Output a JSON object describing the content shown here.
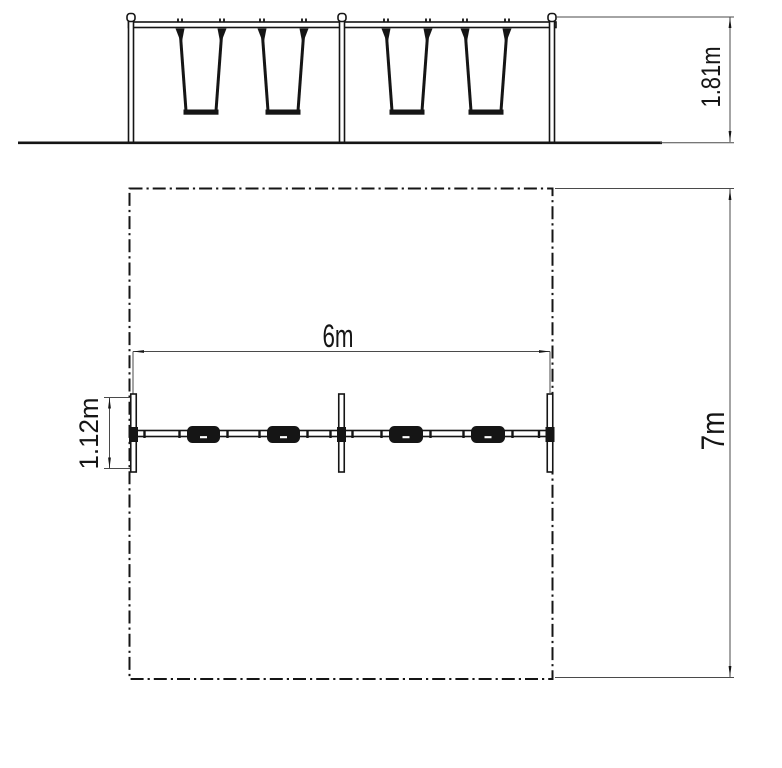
{
  "drawing": {
    "type": "technical-dimension-drawing",
    "subject": "four-seat double-bay swing set, front elevation and plan view with safety zone",
    "elevation_view": {
      "height_dim_label": "1.81m"
    },
    "plan_view": {
      "width_dim_label": "6m",
      "depth_dim_label": "7m",
      "frame_depth_dim_label": "1.12m"
    },
    "colors": {
      "line": "#151515",
      "thin_line": "#4a4a4a",
      "background": "#ffffff"
    }
  }
}
